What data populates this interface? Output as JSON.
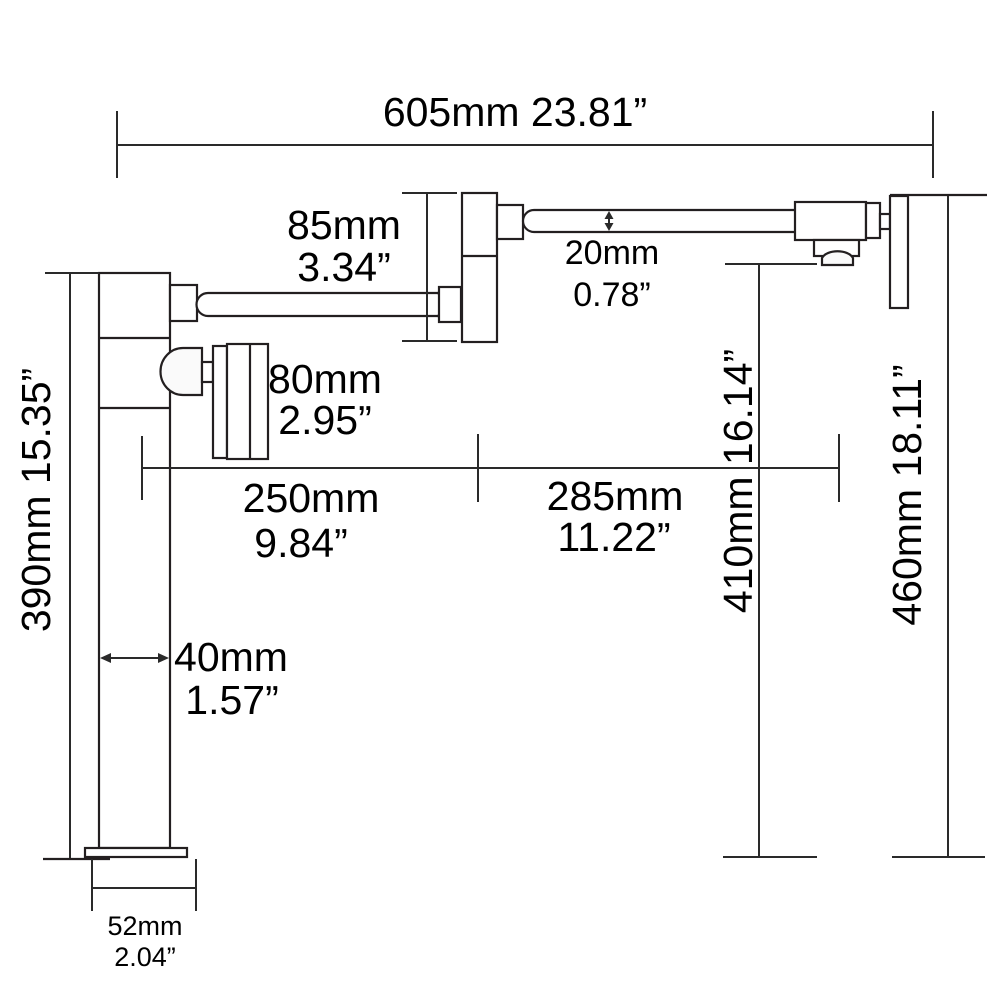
{
  "diagram": {
    "type": "product-dimension-drawing",
    "colors": {
      "background": "#ffffff",
      "line": "#231f20",
      "dimension_line": "#2a2a2a",
      "text": "#000000"
    },
    "dimensions": {
      "total_width": {
        "label": "605mm 23.81”"
      },
      "fold_drop": {
        "mm": "85mm",
        "inch": "3.34”"
      },
      "pipe_diameter": {
        "mm": "20mm",
        "inch": "0.78”"
      },
      "handle_length": {
        "mm": "80mm",
        "inch": "2.95”"
      },
      "left_arm_reach": {
        "mm": "250mm",
        "inch": "9.84”"
      },
      "right_arm_reach": {
        "mm": "285mm",
        "inch": "11.22”"
      },
      "column_height": {
        "label": "390mm 15.35”"
      },
      "spout_height": {
        "label": "410mm 16.14”"
      },
      "wall_height": {
        "label": "460mm 18.11”"
      },
      "column_width": {
        "mm": "40mm",
        "inch": "1.57”"
      },
      "base_width": {
        "mm": "52mm",
        "inch": "2.04”"
      }
    }
  }
}
